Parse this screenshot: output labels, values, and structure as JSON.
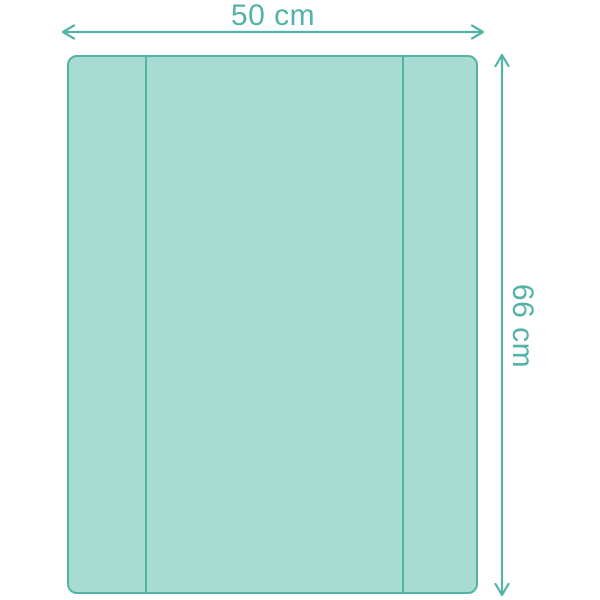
{
  "diagram": {
    "subject": "changing-mat-top-view",
    "dimensions": {
      "width_label": "50 cm",
      "height_label": "66 cm"
    }
  },
  "colors": {
    "outline": "#52B3A6",
    "fill": "#A8DBD2",
    "background": "#FFFFFF"
  }
}
